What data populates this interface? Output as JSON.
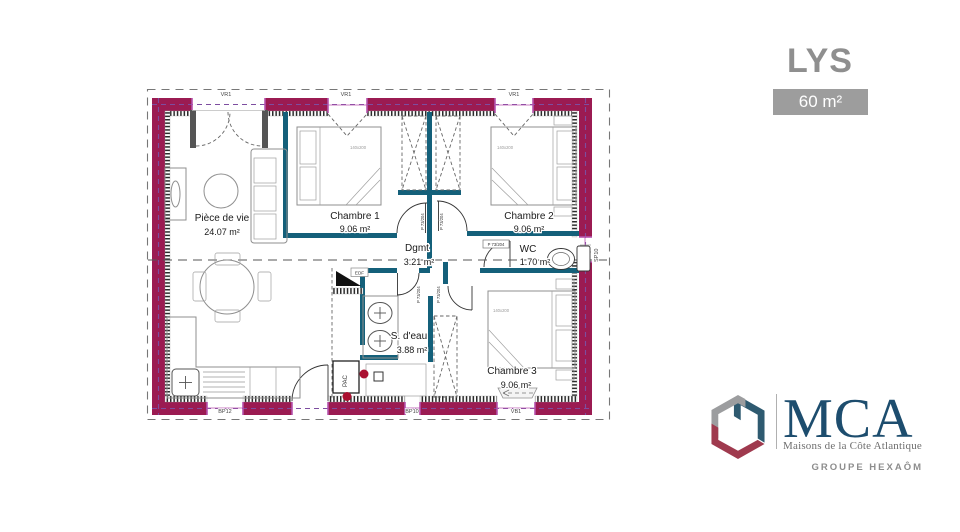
{
  "header": {
    "title": "LYS",
    "area": "60 m²"
  },
  "brand": {
    "name": "MCA",
    "tagline": "Maisons de la Côte Atlantique",
    "group": "GROUPE HEXAÔM",
    "colors": {
      "blue": "#1d4d6e",
      "gray": "#9c9d9f",
      "red": "#9f3a4e"
    }
  },
  "plan": {
    "rooms": [
      {
        "name": "Pièce de vie",
        "area": "24.07 m²"
      },
      {
        "name": "Chambre 1",
        "area": "9.06 m²"
      },
      {
        "name": "Chambre 2",
        "area": "9.06 m²"
      },
      {
        "name": "Dgmt",
        "area": "3.21 m²"
      },
      {
        "name": "WC",
        "area": "1.70 m²"
      },
      {
        "name": "S. d'eau",
        "area": "3.88 m²"
      },
      {
        "name": "Chambre 3",
        "area": "9.06 m²"
      }
    ],
    "codes": {
      "door": "P 73/204",
      "bed": "140x200",
      "top_windows": [
        "VR1",
        "VR1",
        "VR1"
      ],
      "bottom_windows": [
        "BP12",
        "BP10",
        "VB1"
      ],
      "side_door": "SP10",
      "edf": "EDF",
      "pac": "PAC"
    },
    "colors": {
      "exterior_wall": "#9b1b52",
      "interior_wall": "#14607a",
      "window_frame": "#b653ae",
      "centerline": "#7d4da0"
    }
  }
}
